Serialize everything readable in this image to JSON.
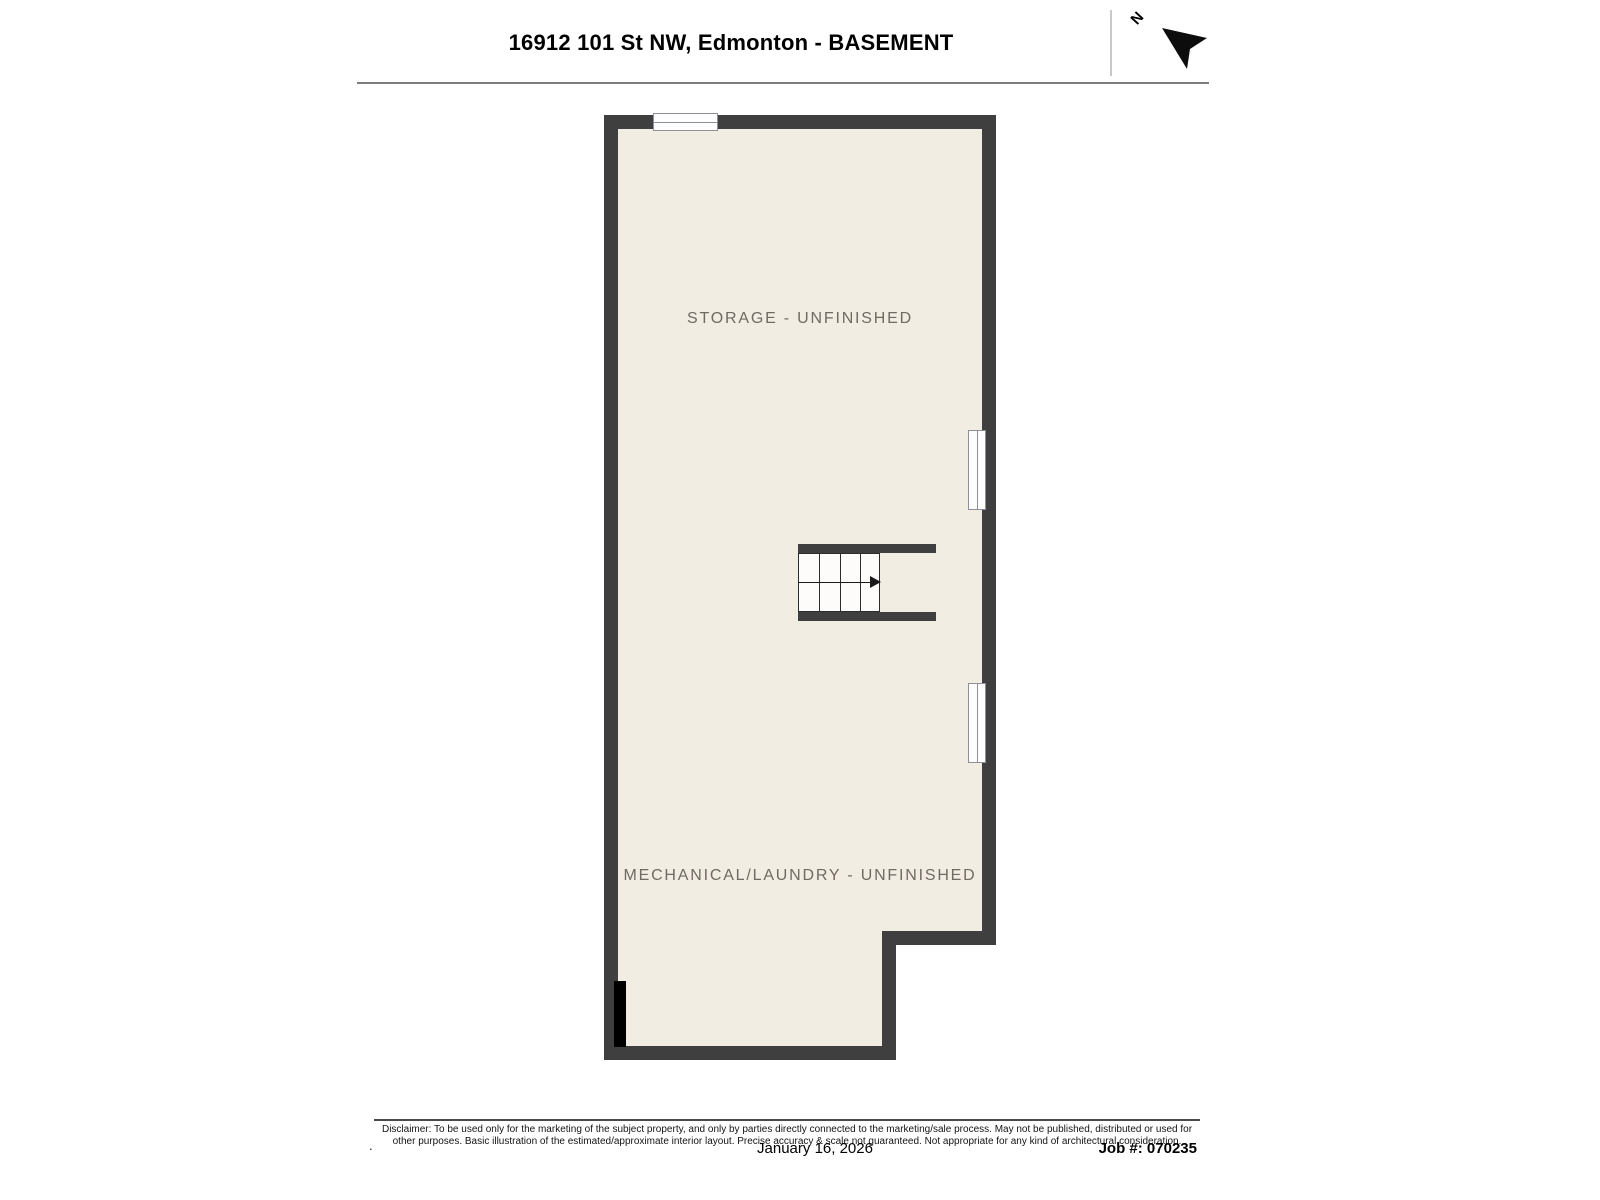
{
  "header": {
    "title": "16912 101 St NW, Edmonton - BASEMENT",
    "north_label": "N"
  },
  "plan": {
    "rooms": [
      {
        "label": "STORAGE - UNFINISHED"
      },
      {
        "label": "MECHANICAL/LAUNDRY - UNFINISHED"
      }
    ],
    "features": [
      "top-window",
      "right-window-upper",
      "right-window-lower",
      "staircase-down",
      "door-opening"
    ],
    "colors": {
      "wall": "#3f3f3f",
      "floor": "#f1ede3",
      "room_label": "#6f6a62",
      "window_frame": "#8f8f99"
    }
  },
  "footer": {
    "disclaimer_line1": "Disclaimer: To be used only for the marketing of the subject property, and only by parties directly connected to the marketing/sale process. May not be published, distributed or used for",
    "disclaimer_line2": "other purposes. Basic illustration of the estimated/approximate interior layout. Precise accuracy & scale not guaranteed. Not appropriate for any kind of architectural consideration.",
    "period_mark": ".",
    "date": "January 16, 2026",
    "job_number": "Job #: 070235"
  }
}
